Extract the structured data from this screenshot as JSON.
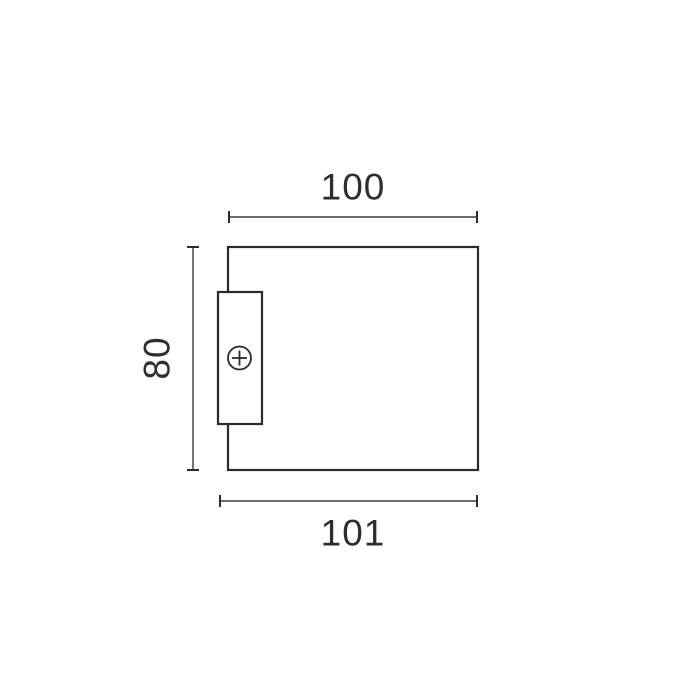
{
  "diagram": {
    "type": "technical-dimension-drawing",
    "background_color": "#ffffff",
    "line_color": "#2b2b2b",
    "dimension_line_color": "#3d3d3d",
    "text_color": "#2e2e2e",
    "dimension_labels": {
      "width_top": "100",
      "height_left": "80",
      "width_bottom": "101"
    },
    "shapes": {
      "main_body": "rectangle",
      "bracket": "small vertical rectangle overlapping left edge",
      "fastener": "cross-head screw symbol (circle with plus)"
    }
  }
}
